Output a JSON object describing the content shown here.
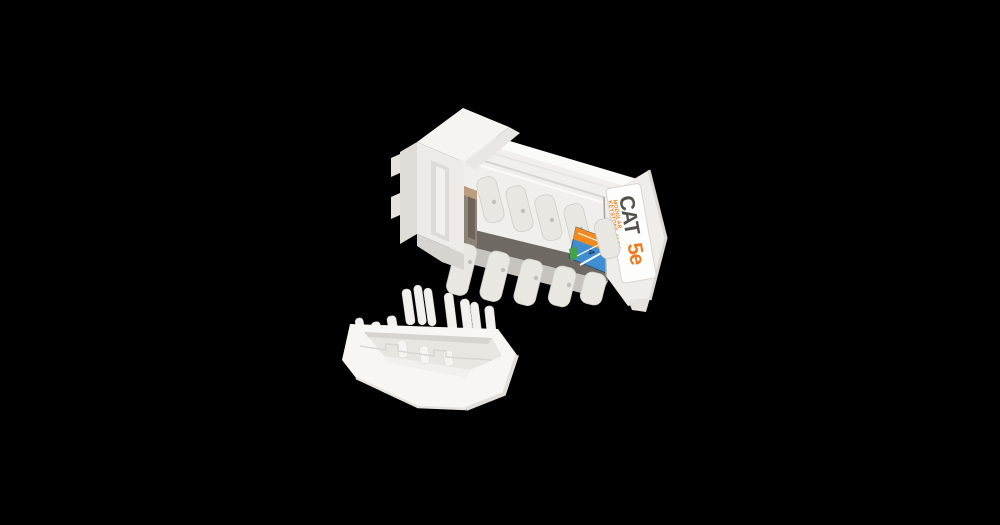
{
  "scene": {
    "background_color": "#000000"
  },
  "jack": {
    "body_color": "#f1efeb",
    "teeth_color": "#e8e7e2",
    "label": {
      "title": "CAT",
      "category": "5e",
      "subtext_line1": "MODULAR",
      "subtext_line2": "KEYSTONE JACK",
      "title_color": "#55504b",
      "accent_color": "#f07a1e",
      "background": "#fdfdfc"
    },
    "wiring_sticker": {
      "pair_number": "4",
      "blue": "#3f8ed2",
      "orange": "#f28a1f",
      "green": "#43a04b",
      "navy": "#1e3a5c"
    }
  },
  "cap": {
    "color": "#f8f6f3"
  }
}
